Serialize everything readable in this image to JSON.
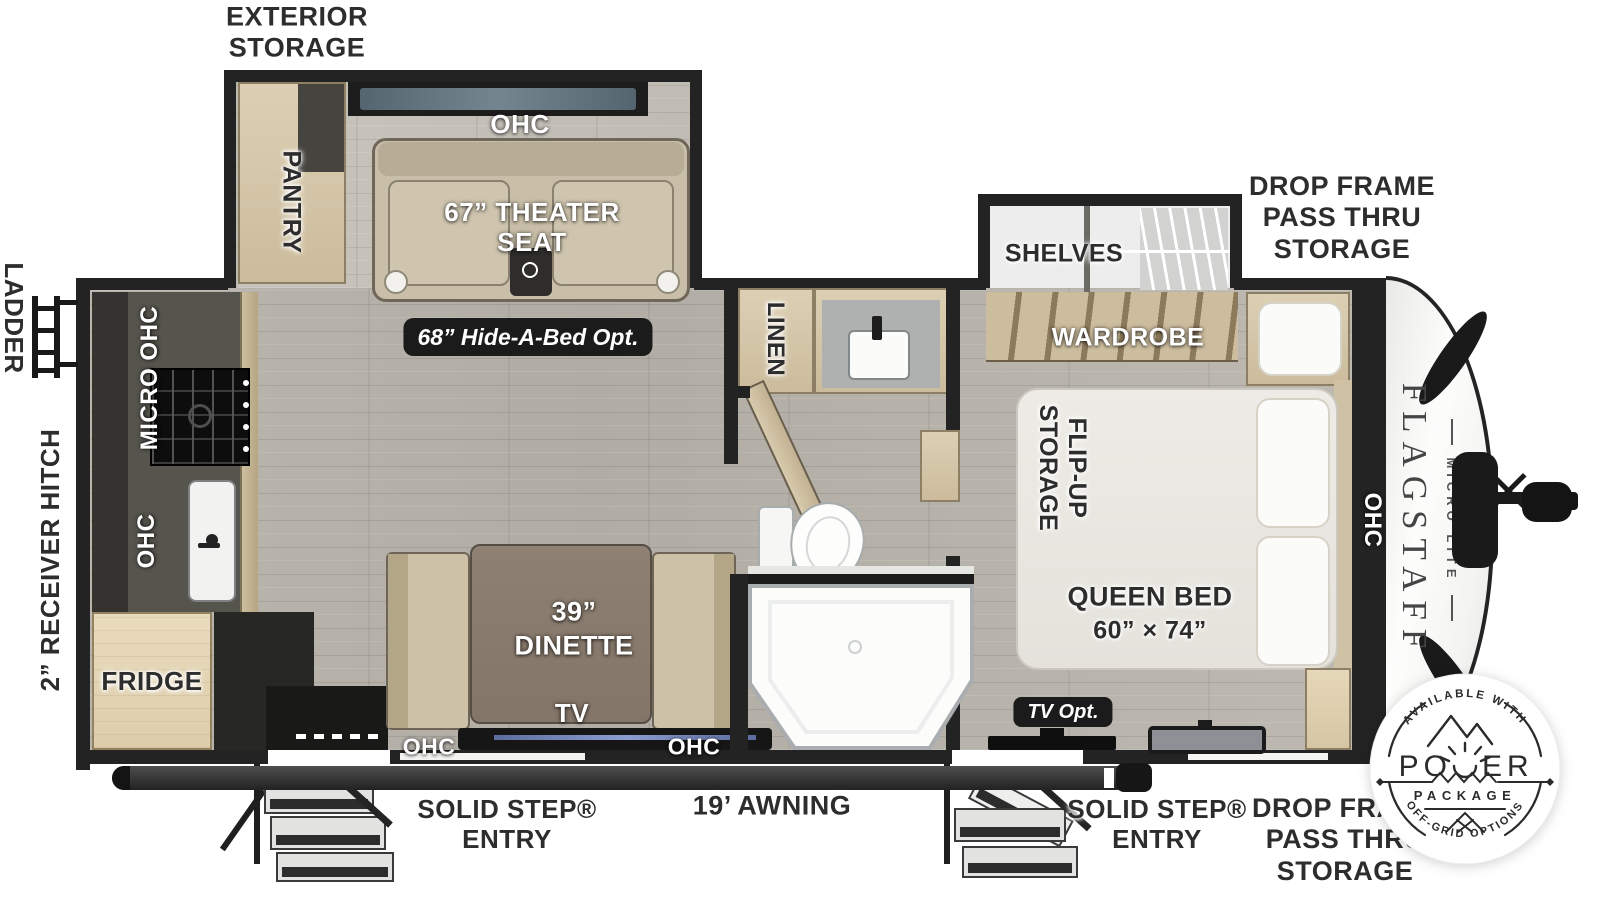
{
  "colors": {
    "wall": "#232323",
    "floor": "#b7b3ab",
    "wood": "#d5c7aa",
    "badge_bg": "#1b1b1b",
    "glass_blue": "#5d6d77",
    "tv_accent": "#8b9cd2"
  },
  "exterior": {
    "exterior_storage": "EXTERIOR\nSTORAGE",
    "drop_frame_top": "DROP FRAME\nPASS THRU\nSTORAGE",
    "drop_frame_bottom": "DROP FRAME\nPASS THRU\nSTORAGE",
    "ladder": "LADDER",
    "receiver_hitch": "2” RECEIVER HITCH",
    "awning": "19’ AWNING",
    "entry_left": "SOLID STEP®\nENTRY",
    "entry_right": "SOLID STEP®\nENTRY"
  },
  "interior": {
    "pantry": "PANTRY",
    "ohc_slide": "OHC",
    "theater_seat": "67” THEATER\nSEAT",
    "hide_a_bed": "68” Hide-A-Bed Opt.",
    "shelves": "SHELVES",
    "wardrobe": "WARDROBE",
    "flip_up_storage": "FLIP-UP\nSTORAGE",
    "queen_bed": "QUEEN BED",
    "queen_bed_size": "60” × 74”",
    "ohc_bed": "OHC",
    "linen": "LINEN",
    "micro_ohc": "MICRO OHC",
    "ohc_kitchen": "OHC",
    "fridge": "FRIDGE",
    "dinette_size": "39”",
    "dinette": "DINETTE",
    "tv": "TV",
    "ohc_dinette_left": "OHC",
    "ohc_dinette_right": "OHC",
    "tv_opt": "TV Opt."
  },
  "brand": {
    "name": "FLAGSTAFF",
    "series": "MICRO LITE"
  },
  "power_badge": {
    "top_arc": "AVAILABLE WITH",
    "power_left": "PO",
    "power_right": "ER",
    "package": "PACKAGE",
    "bottom_arc": "OFF-GRID OPTIONS"
  }
}
